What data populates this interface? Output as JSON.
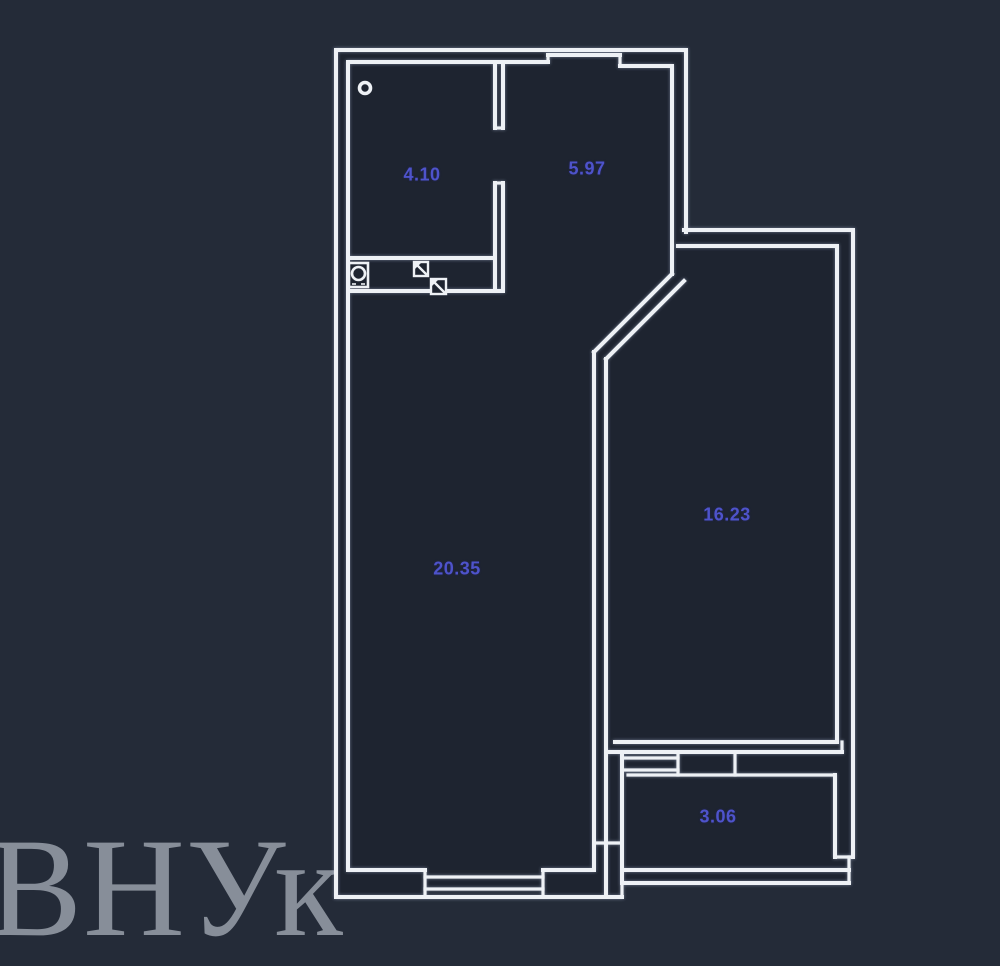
{
  "watermark": {
    "text": "ВНУк"
  },
  "rooms": [
    {
      "name": "bathroom",
      "area": "4.10"
    },
    {
      "name": "hallway",
      "area": "5.97"
    },
    {
      "name": "living-room",
      "area": "20.35"
    },
    {
      "name": "bedroom",
      "area": "16.23"
    },
    {
      "name": "balcony",
      "area": "3.06"
    }
  ],
  "icons": [
    "pipe-riser-icon",
    "washing-machine-icon",
    "vent-shaft-icon"
  ],
  "colors": {
    "background": "#242b38",
    "room_fill": "#1e2430",
    "wall": "#eef1f5",
    "area_label": "#4e53cb",
    "watermark": "#878e99"
  }
}
